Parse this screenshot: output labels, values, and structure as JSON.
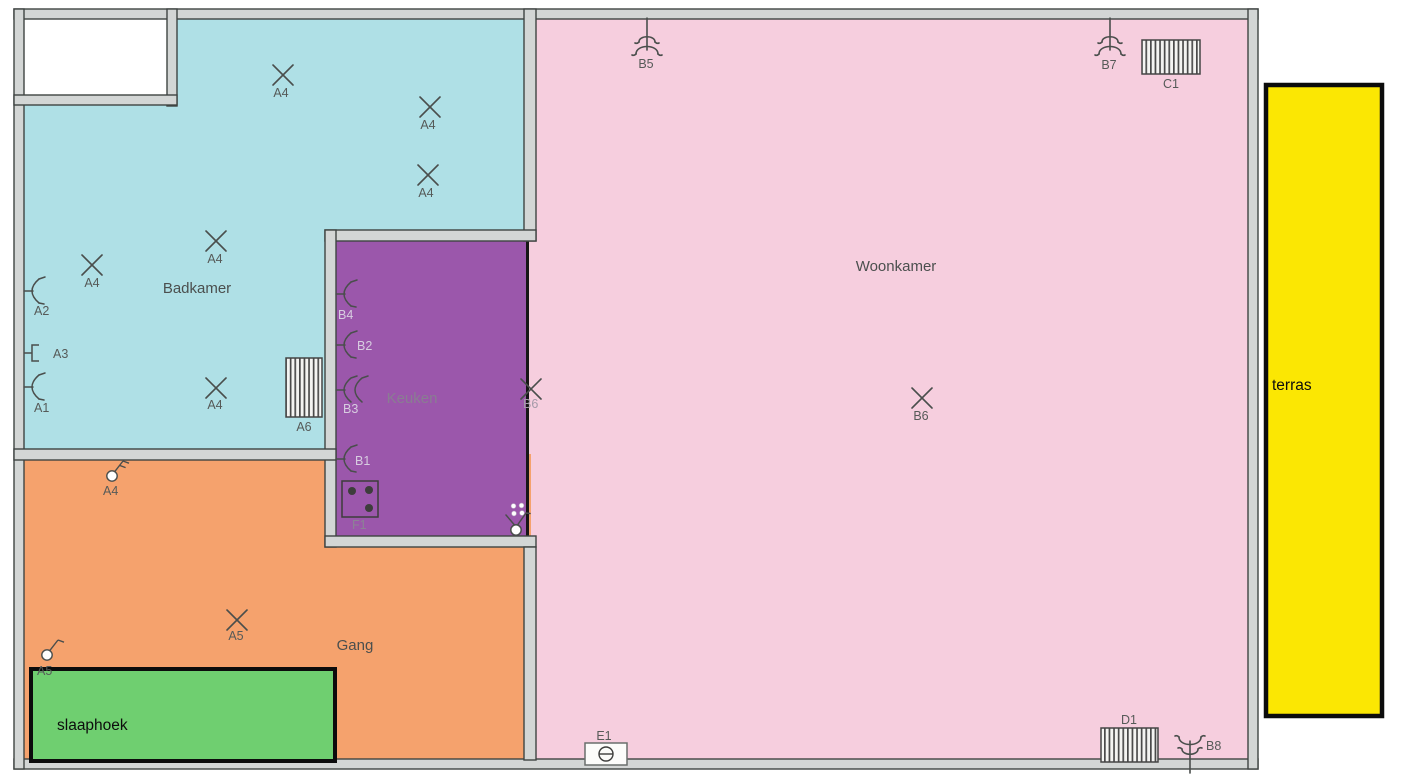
{
  "plan": {
    "type": "floor-plan",
    "language": "nl",
    "wall_color": "#d3d6d5",
    "wall_edge_color": "#3f4442",
    "symbol_stroke_color": "#4a4e4c",
    "rooms": [
      {
        "name": "Badkamer",
        "color": "#afe0e6"
      },
      {
        "name": "Keuken",
        "color": "#9b57ab"
      },
      {
        "name": "Woonkamer",
        "color": "#f6cede"
      },
      {
        "name": "Gang",
        "color": "#f5a26d"
      },
      {
        "name": "slaaphoek",
        "color": "#6fcf70"
      },
      {
        "name": "terras",
        "color": "#fbe703"
      }
    ],
    "symbols": [
      {
        "type": "ceiling-light-point",
        "room": "Badkamer",
        "label": "A4"
      },
      {
        "type": "ceiling-light-point",
        "room": "Badkamer",
        "label": "A4"
      },
      {
        "type": "ceiling-light-point",
        "room": "Badkamer",
        "label": "A4"
      },
      {
        "type": "ceiling-light-point",
        "room": "Badkamer",
        "label": "A4"
      },
      {
        "type": "ceiling-light-point",
        "room": "Badkamer",
        "label": "A4"
      },
      {
        "type": "wall-light-point",
        "room": "Badkamer",
        "label": "A2"
      },
      {
        "type": "wall-connection-box",
        "room": "Badkamer",
        "label": "A3"
      },
      {
        "type": "wall-light-point",
        "room": "Badkamer",
        "label": "A1"
      },
      {
        "type": "ceiling-light-point",
        "room": "Badkamer",
        "label": "A4"
      },
      {
        "type": "radiator",
        "room": "Badkamer",
        "label": "A6"
      },
      {
        "type": "ceiling-fixture",
        "room": "Woonkamer",
        "label": "B5"
      },
      {
        "type": "ceiling-fixture",
        "room": "Woonkamer",
        "label": "B7"
      },
      {
        "type": "radiator",
        "room": "Woonkamer",
        "label": "C1"
      },
      {
        "type": "ceiling-light-point",
        "room": "Woonkamer",
        "label": "B6"
      },
      {
        "type": "ceiling-light-point",
        "room": "Keuken",
        "label": "B6"
      },
      {
        "type": "wall-light-point",
        "room": "Keuken",
        "label": "B4"
      },
      {
        "type": "wall-light-point",
        "room": "Keuken",
        "label": "B2"
      },
      {
        "type": "wall-light-point-double",
        "room": "Keuken",
        "label": "B3"
      },
      {
        "type": "wall-light-point",
        "room": "Keuken",
        "label": "B1"
      },
      {
        "type": "cooker",
        "room": "Keuken",
        "label": "F1"
      },
      {
        "type": "double-socket"
      },
      {
        "type": "wall-socket"
      },
      {
        "type": "switch-series",
        "room": "Gang",
        "label": "A4"
      },
      {
        "type": "ceiling-light-point",
        "room": "Gang",
        "label": "A5"
      },
      {
        "type": "switch-single",
        "room": "Gang",
        "label": "A5"
      },
      {
        "type": "radiator",
        "room": "Woonkamer",
        "label": "D1"
      },
      {
        "type": "ceiling-fixture",
        "room": "Woonkamer",
        "label": "B8"
      },
      {
        "type": "wall-box",
        "room": "Woonkamer",
        "label": "E1"
      }
    ]
  }
}
